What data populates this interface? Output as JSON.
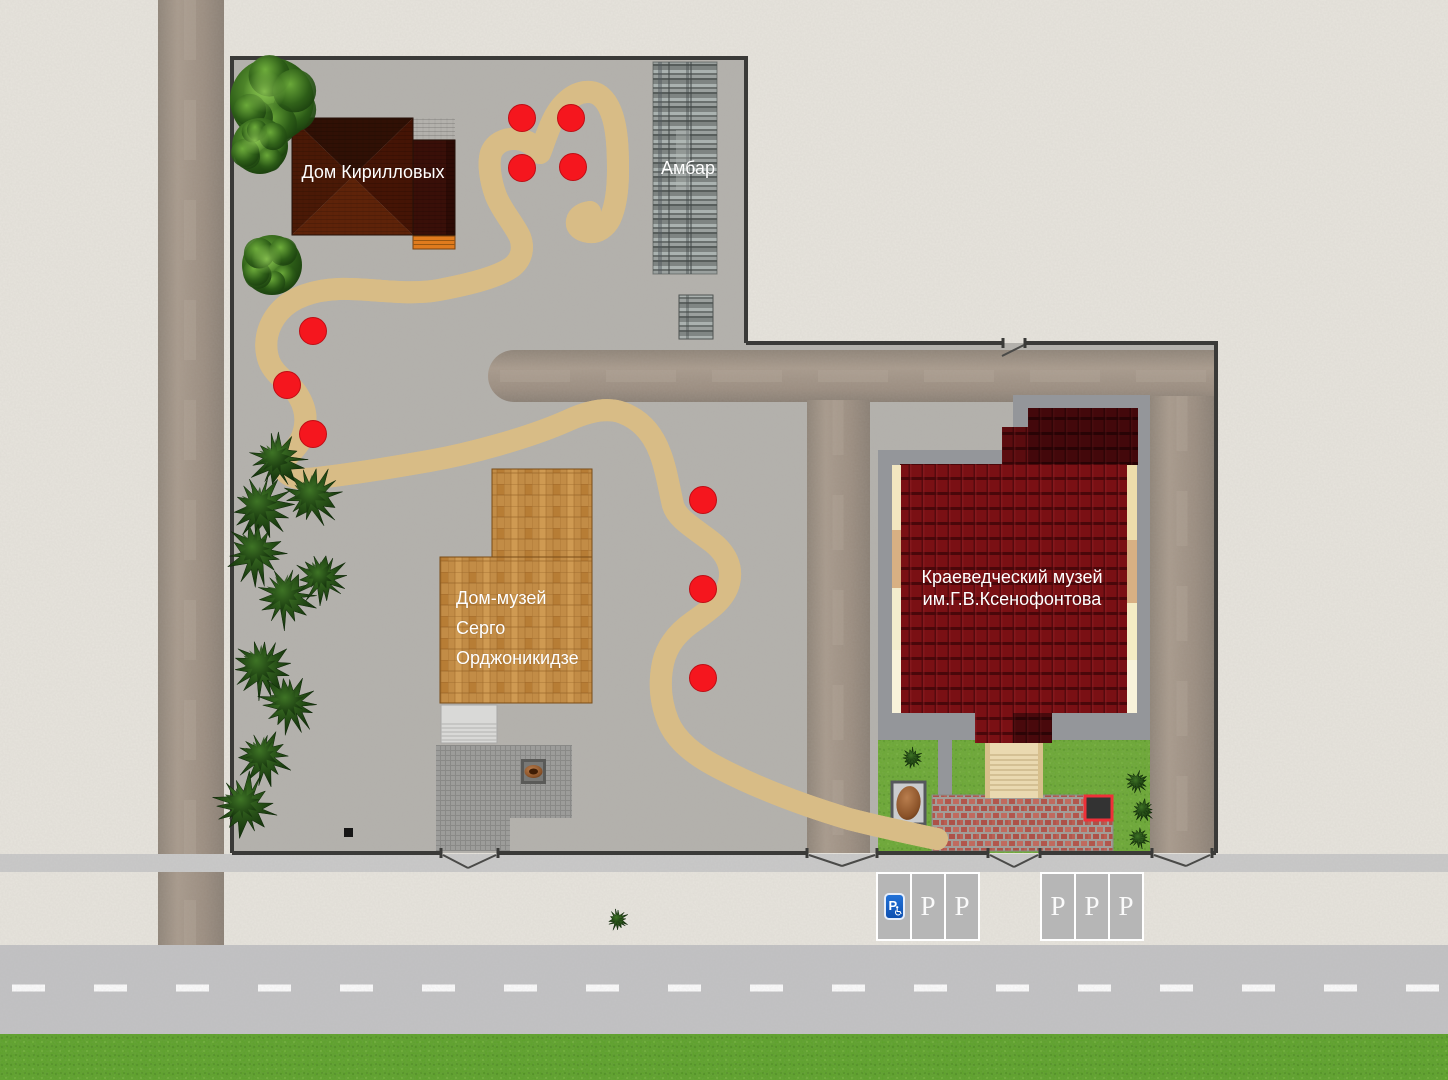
{
  "map": {
    "labels": {
      "kirillov_house": "Дом Кирилловых",
      "barn": "Амбар",
      "ordzhonikidze_house_museum": [
        "Дом-музей",
        "Серго",
        "Орджоникидзе"
      ],
      "ksenofontov_local_history_museum": [
        "Краеведческий музей",
        "им.Г.В.Ксенофонтова"
      ]
    },
    "route_markers": {
      "color": "#f5161e",
      "points": [
        [
          522,
          118
        ],
        [
          571,
          118
        ],
        [
          522,
          168
        ],
        [
          573,
          167
        ],
        [
          313,
          331
        ],
        [
          287,
          385
        ],
        [
          313,
          434
        ],
        [
          703,
          500
        ],
        [
          703,
          589
        ],
        [
          703,
          678
        ]
      ]
    },
    "parking": {
      "disabled_sign_letter": "P",
      "disabled_sign_color": "#1566cc",
      "group1": [
        "",
        "P",
        "P"
      ],
      "group2": [
        "P",
        "P",
        "P"
      ]
    },
    "colors": {
      "background": "#e7e4dd",
      "territory": "#b3b1ac",
      "path": "#f1dfb4",
      "marker": "#f5161e",
      "museum_roof": "#7a1014",
      "kirillov_roof": "#4f1b06",
      "wood_house": "#c28c46",
      "lawn": "#6aa833",
      "street": "#c2c2c4",
      "grass": "#5ba128"
    }
  }
}
